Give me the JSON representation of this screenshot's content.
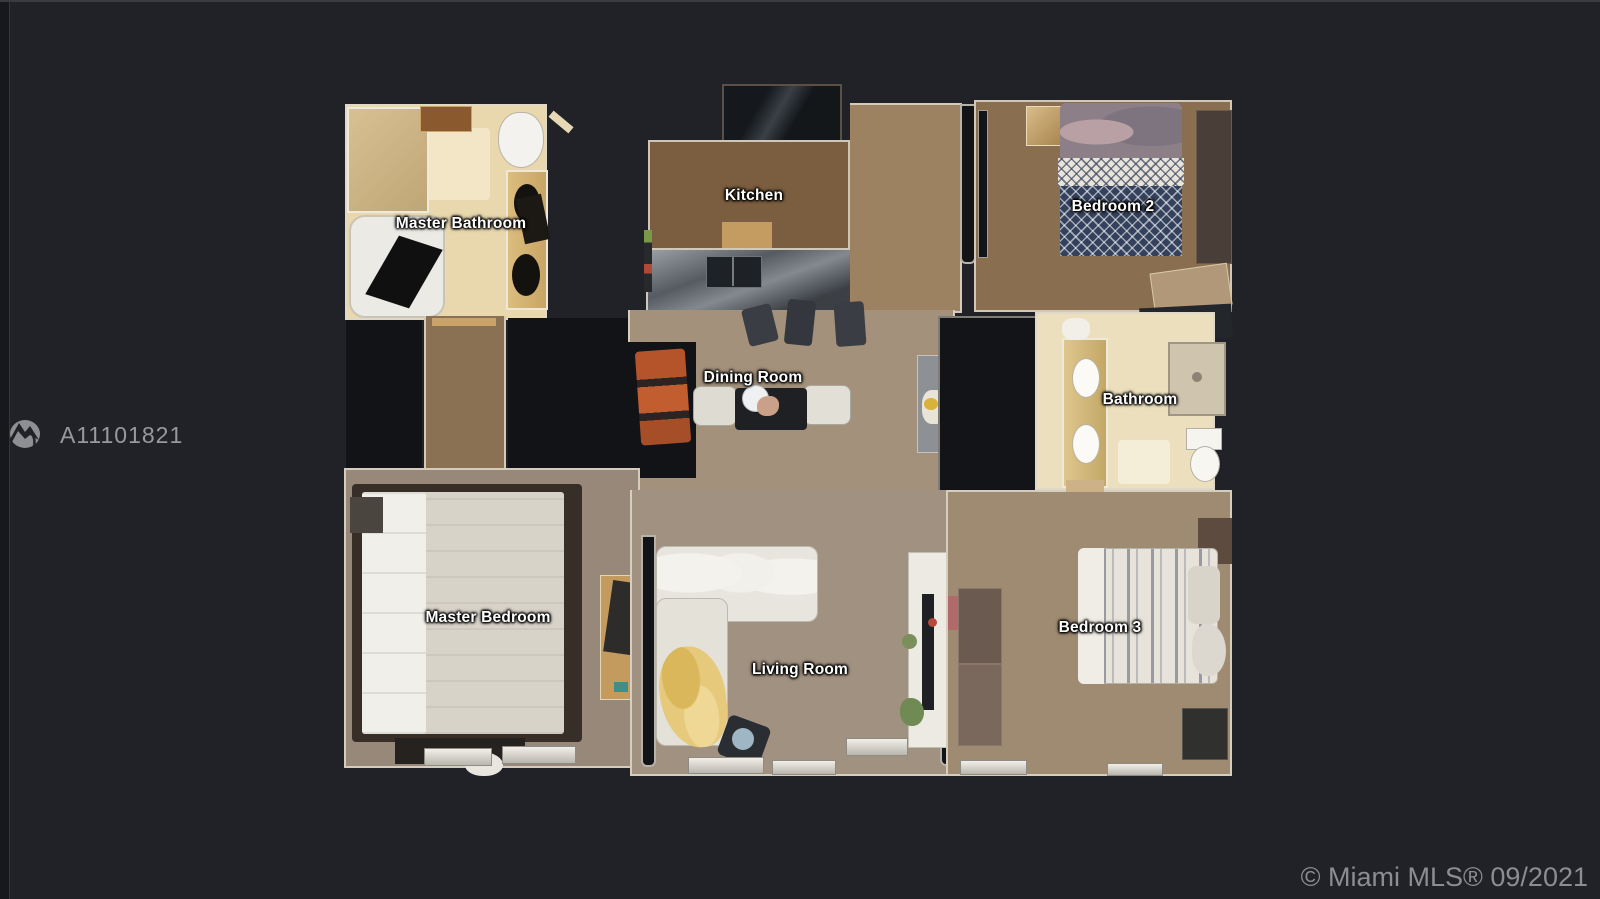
{
  "branding": {
    "logo_icon": "mountain-circle-logo",
    "mls_id": "A11101821",
    "watermark": "© Miami MLS® 09/2021"
  },
  "floorplan": {
    "type": "top-down 3D scan floor plan",
    "rooms": [
      {
        "key": "master-bathroom",
        "label": "Master Bathroom"
      },
      {
        "key": "kitchen",
        "label": "Kitchen"
      },
      {
        "key": "bedroom-2",
        "label": "Bedroom 2"
      },
      {
        "key": "dining-room",
        "label": "Dining Room"
      },
      {
        "key": "bathroom",
        "label": "Bathroom"
      },
      {
        "key": "master-bedroom",
        "label": "Master Bedroom"
      },
      {
        "key": "living-room",
        "label": "Living Room"
      },
      {
        "key": "bedroom-3",
        "label": "Bedroom 3"
      }
    ]
  },
  "colors": {
    "background": "#212227",
    "label_text": "#ffffff",
    "mls_id_text": "#97999d",
    "watermark_text": "#8b8d91",
    "bathroom_tile": "#ebdfbd",
    "kitchen_tile": "#7b5e40",
    "carpet_taupe": "#a19181",
    "carpet_brown": "#8a6e50",
    "blanket_navy": "#33415c",
    "blanket_yellow": "#e6c97a"
  }
}
